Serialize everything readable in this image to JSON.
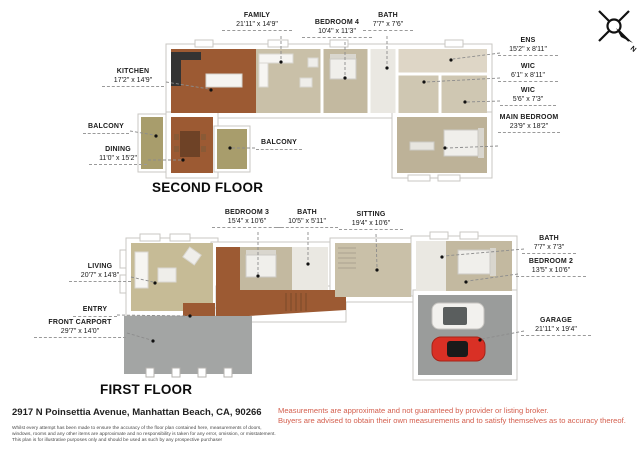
{
  "document": {
    "type": "real-estate-floor-plan",
    "address": "2917 N Poinsettia Avenue, Manhattan Beach, CA, 90266"
  },
  "compass": {
    "north_label": "N"
  },
  "second_floor": {
    "title": "SECOND FLOOR",
    "labels": [
      {
        "name": "FAMILY",
        "dims": "21'11\" x 14'9\""
      },
      {
        "name": "BEDROOM 4",
        "dims": "10'4\" x 11'3\""
      },
      {
        "name": "BATH",
        "dims": "7'7\" x 7'6\""
      },
      {
        "name": "ENS",
        "dims": "15'2\" x 8'11\""
      },
      {
        "name": "WIC",
        "dims": "6'1\" x 8'11\""
      },
      {
        "name": "WIC",
        "dims": "5'6\" x 7'3\""
      },
      {
        "name": "MAIN BEDROOM",
        "dims": "23'9\" x 18'2\""
      },
      {
        "name": "KITCHEN",
        "dims": "17'2\" x 14'9\""
      },
      {
        "name": "BALCONY",
        "dims": ""
      },
      {
        "name": "DINING",
        "dims": "11'0\" x 15'2\""
      },
      {
        "name": "BALCONY",
        "dims": ""
      }
    ]
  },
  "first_floor": {
    "title": "FIRST FLOOR",
    "labels": [
      {
        "name": "BEDROOM 3",
        "dims": "15'4\" x 10'6\""
      },
      {
        "name": "BATH",
        "dims": "10'5\" x 5'11\""
      },
      {
        "name": "SITTING",
        "dims": "19'4\" x 10'6\""
      },
      {
        "name": "LIVING",
        "dims": "20'7\" x 14'8\""
      },
      {
        "name": "ENTRY",
        "dims": ""
      },
      {
        "name": "FRONT CARPORT",
        "dims": "29'7\" x 14'0\""
      },
      {
        "name": "BATH",
        "dims": "7'7\" x 7'3\""
      },
      {
        "name": "BEDROOM 2",
        "dims": "13'5\" x 10'6\""
      },
      {
        "name": "GARAGE",
        "dims": "21'11\" x 19'4\""
      }
    ]
  },
  "footer": {
    "address": "2917 N Poinsettia Avenue, Manhattan Beach, CA, 90266",
    "fine_print_lines": [
      "Whilst every attempt has been made to ensure the accuracy of the floor plan contained here, measurements of doors,",
      "windows, rooms and any other items are approximate and no responsibility is taken for any error, omission, or misstatement.",
      "This plan is for illustrative purposes only and should be used as such by any prospective purchaser"
    ],
    "disclaimer_lines": [
      "Measurements are approximate and not guaranteed by provider or listing broker.",
      "Buyers are advised to obtain their own measurements and to satisfy themselves as to accuracy thereof."
    ]
  },
  "colors": {
    "wood_floor": "#9c5a33",
    "carpet_light": "#c9c0a8",
    "carpet_mid": "#c3b9a0",
    "carpet_dark": "#bdb298",
    "balcony": "#a89d6c",
    "tile_white": "#eae8e2",
    "ens_tile": "#ded6c6",
    "wic_carpet": "#cfc7b2",
    "garage_gray": "#9a9c9b",
    "carport_gray": "#a3a5a4",
    "disclaimer_red": "#d4604f",
    "car_red": "#d93025",
    "car_white": "#f2f1ee"
  }
}
